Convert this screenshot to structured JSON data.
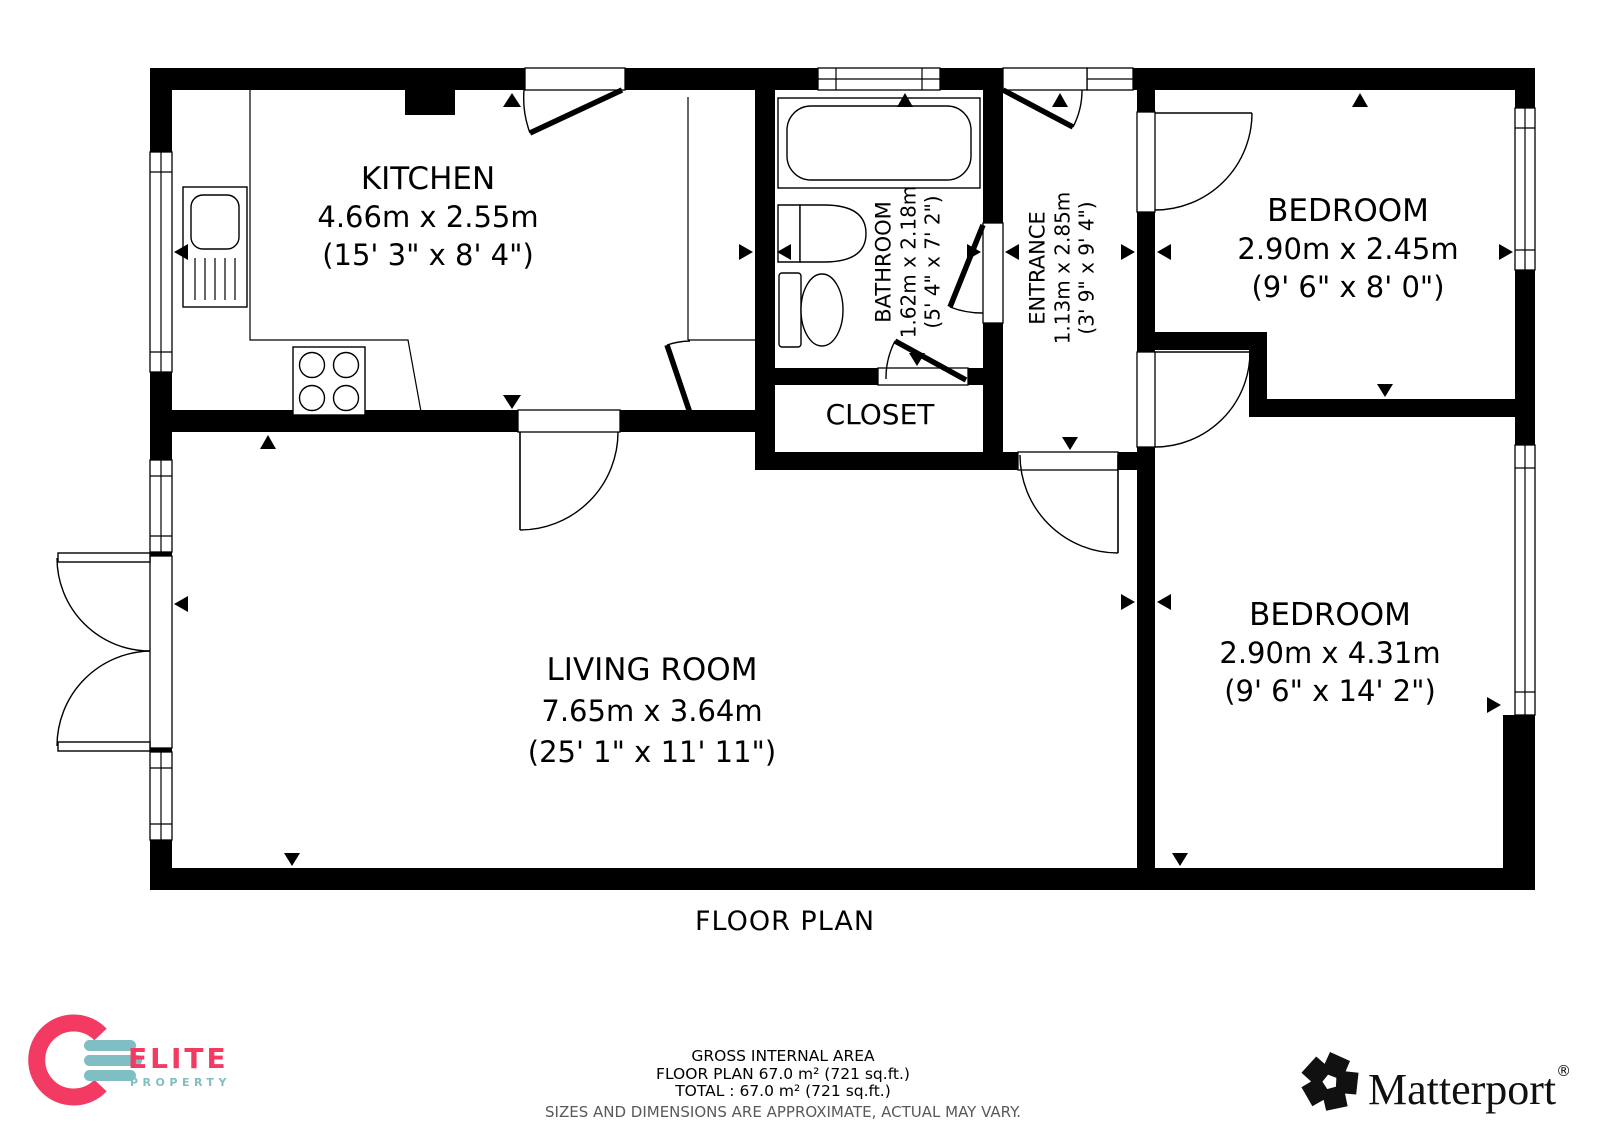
{
  "plan": {
    "caption": "FLOOR PLAN",
    "rooms": {
      "kitchen": {
        "name": "KITCHEN",
        "metric": "4.66m x 2.55m",
        "imperial": "(15' 3\" x 8' 4\")"
      },
      "bathroom": {
        "name": "BATHROOM",
        "metric": "1.62m x 2.18m",
        "imperial": "(5' 4\" x 7' 2\")"
      },
      "entrance": {
        "name": "ENTRANCE",
        "metric": "1.13m x 2.85m",
        "imperial": "(3' 9\" x 9' 4\")"
      },
      "closet": {
        "name": "CLOSET"
      },
      "bedroom_top": {
        "name": "BEDROOM",
        "metric": "2.90m x 2.45m",
        "imperial": "(9' 6\" x 8' 0\")"
      },
      "living_room": {
        "name": "LIVING ROOM",
        "metric": "7.65m x 3.64m",
        "imperial": "(25' 1\" x 11' 11\")"
      },
      "bedroom_bottom": {
        "name": "BEDROOM",
        "metric": "2.90m x 4.31m",
        "imperial": "(9' 6\" x 14' 2\")"
      }
    }
  },
  "footer": {
    "area_title": "GROSS INTERNAL AREA",
    "floor_line": "FLOOR PLAN 67.0 m² (721 sq.ft.)",
    "total_line": "TOTAL :  67.0 m² (721 sq.ft.)",
    "disclaimer": "SIZES AND DIMENSIONS ARE APPROXIMATE, ACTUAL MAY VARY."
  },
  "branding": {
    "elite": {
      "title": "ELITE",
      "subtitle": "PROPERTY",
      "accent_pink": "#F23A62",
      "accent_teal": "#7FBEC2"
    },
    "matterport": {
      "title": "Matterport",
      "registered": "®"
    }
  }
}
